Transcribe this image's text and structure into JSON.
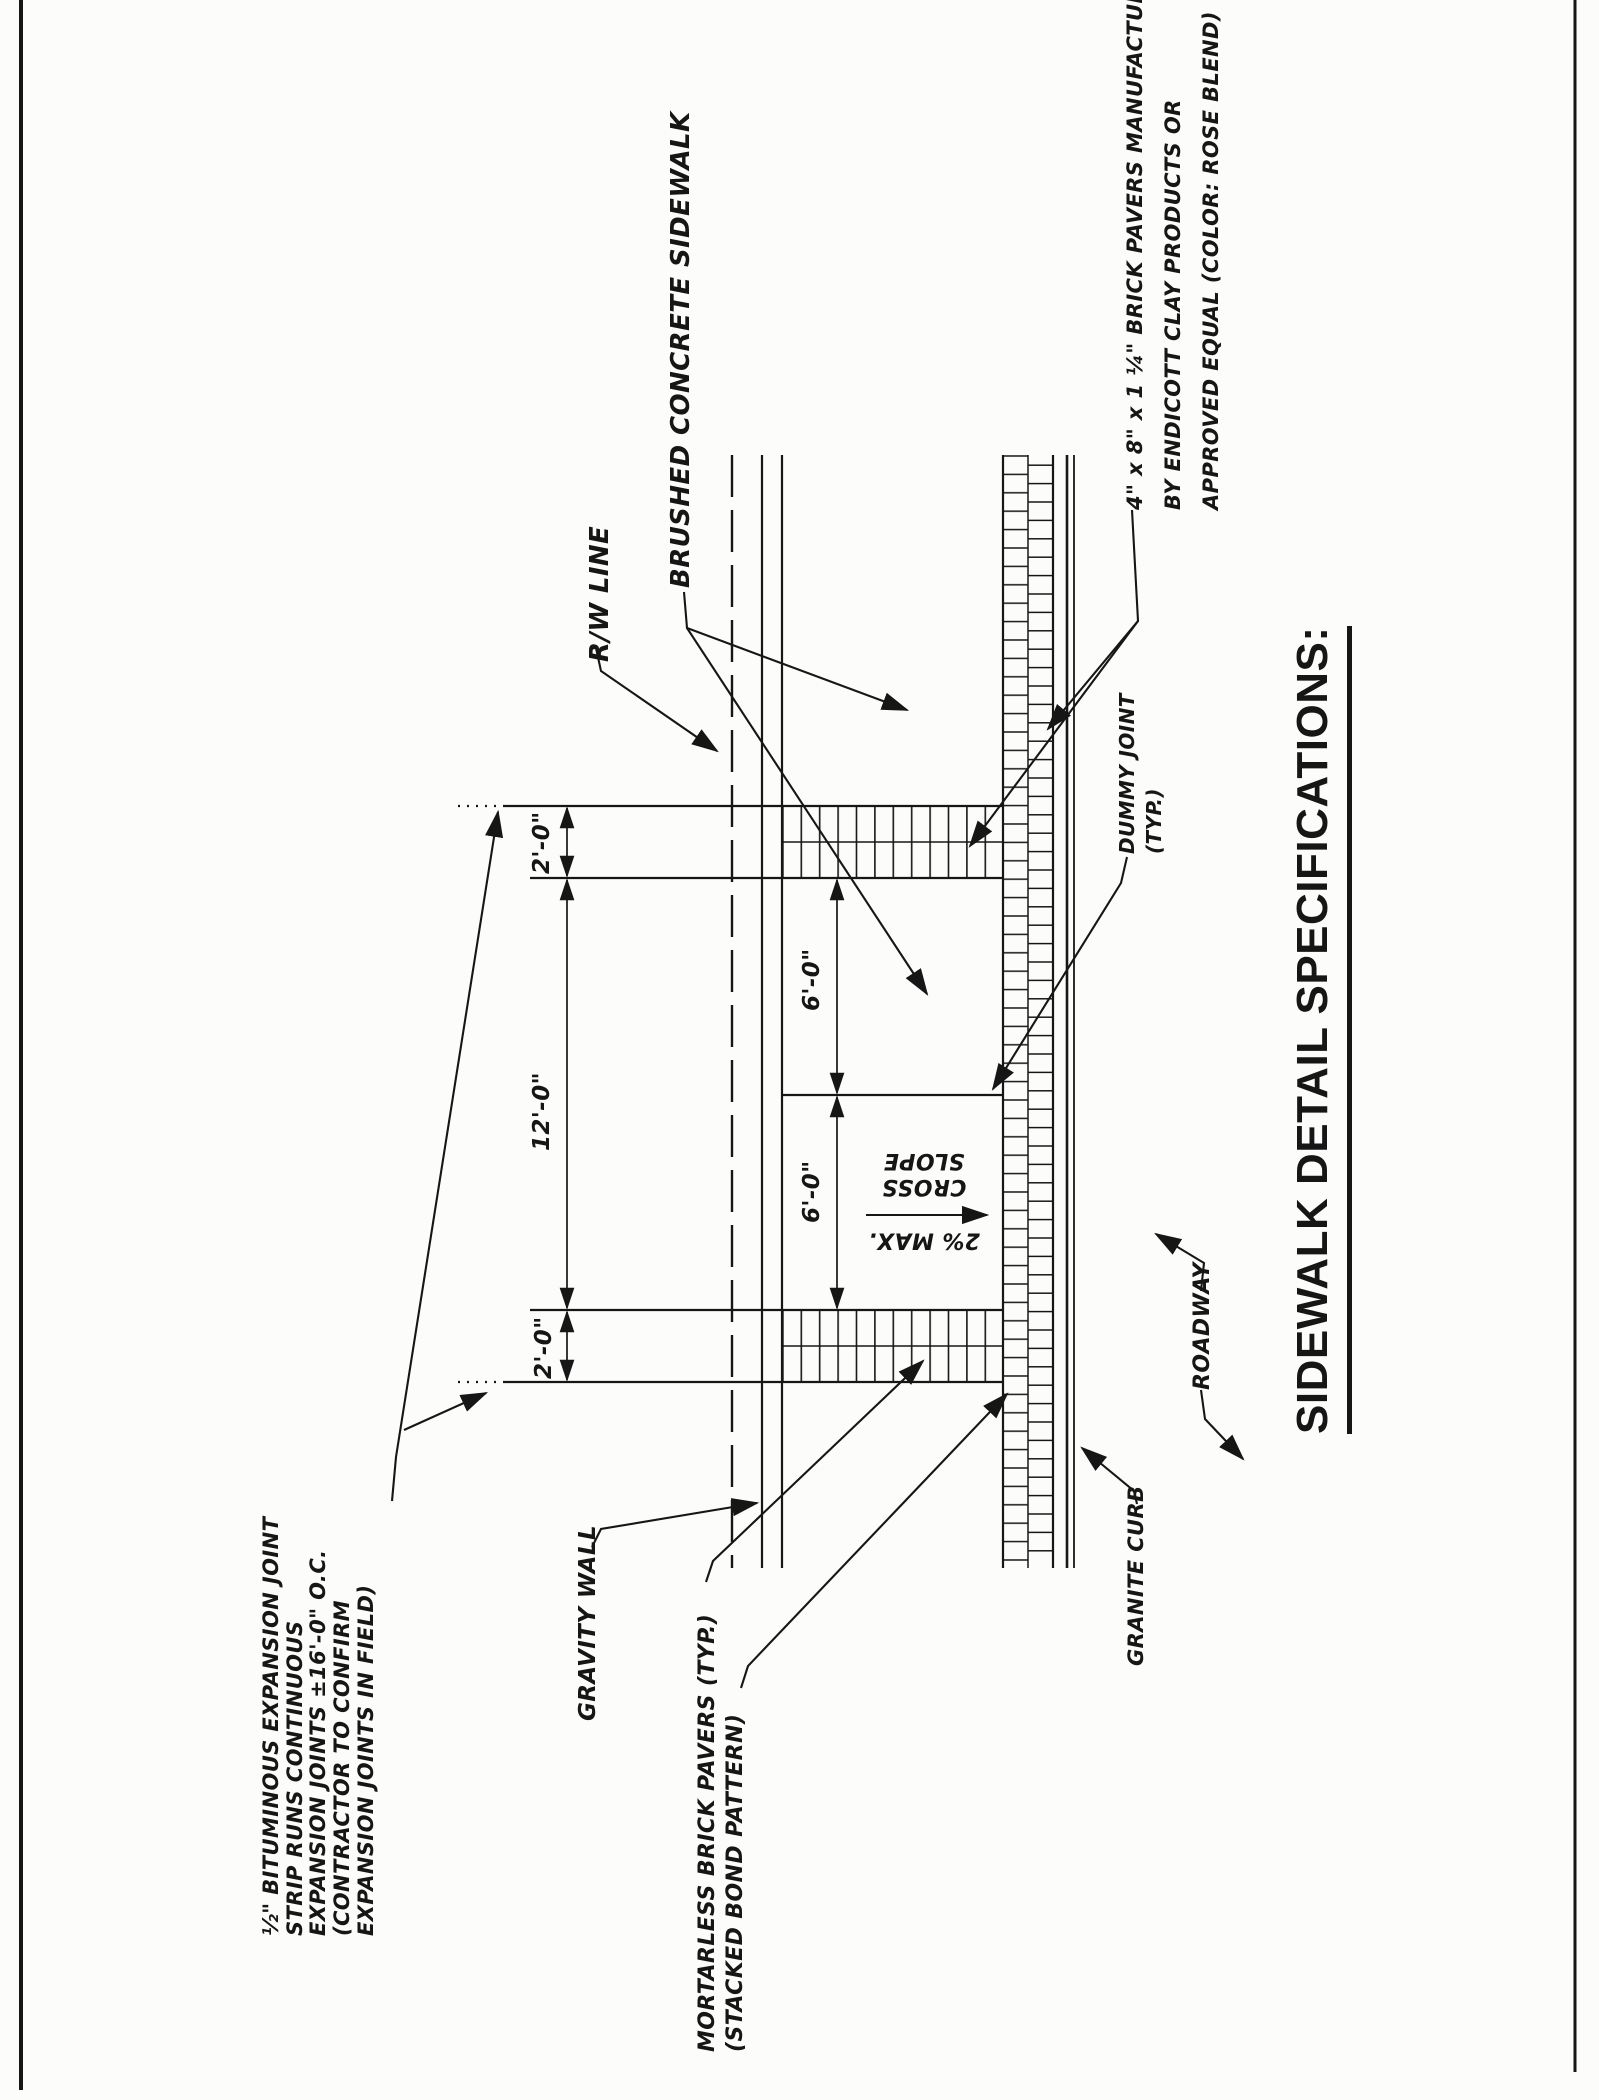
{
  "title": "SIDEWALK DETAIL SPECIFICATIONS:",
  "labels": {
    "rw_line": "R/W LINE",
    "brushed_concrete": "BRUSHED CONCRETE SIDEWALK",
    "brick_paver_note": "4\" x 8\" x 1 ¼\" BRICK PAVERS MANUFACTURED\nBY ENDICOTT CLAY PRODUCTS OR\nAPPROVED EQUAL (COLOR: ROSE BLEND)",
    "expansion_joint_note": "½\" BITUMINOUS EXPANSION JOINT\nSTRIP RUNS CONTINUOUS\nEXPANSION JOINTS ±16'-0\" O.C.\n(CONTRACTOR TO CONFIRM\nEXPANSION JOINTS IN FIELD)",
    "gravity_wall": "GRAVITY WALL",
    "mortarless_note": "MORTARLESS BRICK PAVERS (TYP.)\n(STACKED BOND PATTERN)",
    "granite_curb": "GRANITE CURB",
    "roadway": "ROADWAY",
    "dummy_joint": "DUMMY JOINT\n(TYP.)",
    "cross_slope_value": "2% MAX.",
    "cross_slope_words": "CROSS\nSLOPE"
  },
  "dimensions": {
    "paver_band_top": "2'-0\"",
    "sidewalk_width": "12'-0\"",
    "panel_upper": "6'-0\"",
    "panel_lower": "6'-0\"",
    "paver_band_bottom": "2'-0\""
  },
  "colors": {
    "ink": "#161616",
    "paper": "#fcfcfa"
  }
}
